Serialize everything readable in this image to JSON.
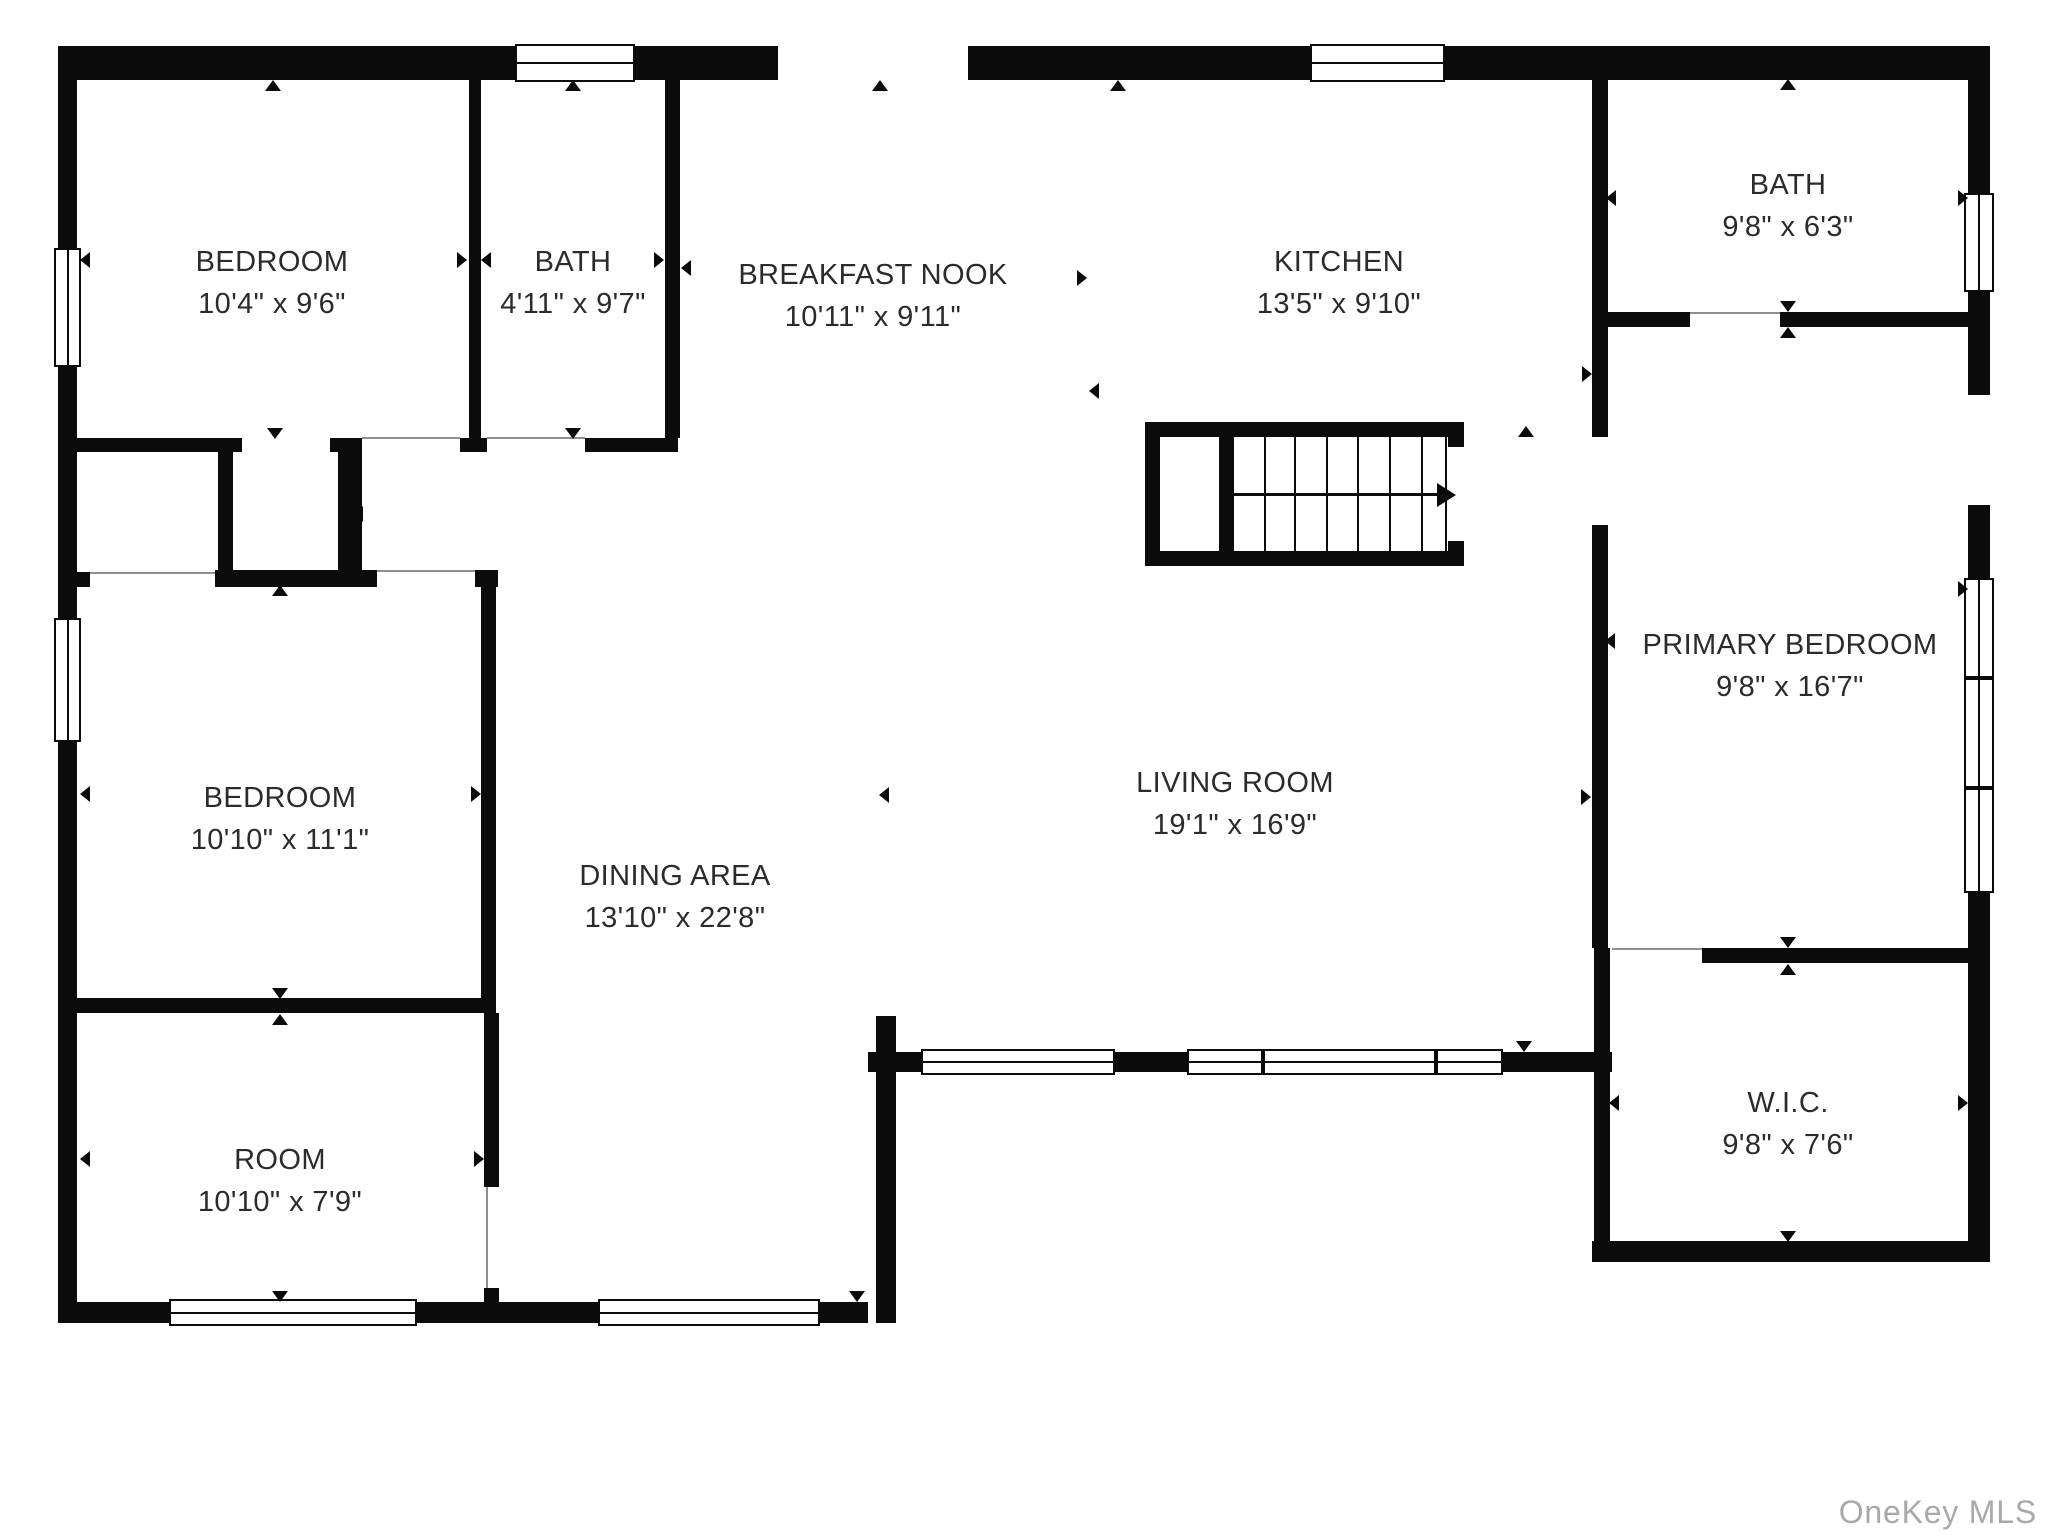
{
  "page": {
    "background": "#ffffff",
    "wall_color": "#0b0b0b",
    "label_color": "#2b2b2b",
    "watermark_color": "#a9a9a9"
  },
  "watermark": "OneKey MLS",
  "rooms": [
    {
      "id": "bedroom-1",
      "name": "BEDROOM",
      "dims": "10'4\" x 9'6\""
    },
    {
      "id": "bath-1",
      "name": "BATH",
      "dims": "4'11\" x 9'7\""
    },
    {
      "id": "breakfast-nook",
      "name": "BREAKFAST NOOK",
      "dims": "10'11\" x 9'11\""
    },
    {
      "id": "kitchen",
      "name": "KITCHEN",
      "dims": "13'5\" x 9'10\""
    },
    {
      "id": "bath-2",
      "name": "BATH",
      "dims": "9'8\" x 6'3\""
    },
    {
      "id": "primary-bedroom",
      "name": "PRIMARY BEDROOM",
      "dims": "9'8\" x 16'7\""
    },
    {
      "id": "wic",
      "name": "W.I.C.",
      "dims": "9'8\" x 7'6\""
    },
    {
      "id": "bedroom-2",
      "name": "BEDROOM",
      "dims": "10'10\" x 11'1\""
    },
    {
      "id": "dining-area",
      "name": "DINING AREA",
      "dims": "13'10\" x 22'8\""
    },
    {
      "id": "living-room",
      "name": "LIVING ROOM",
      "dims": "19'1\" x 16'9\""
    },
    {
      "id": "room",
      "name": "ROOM",
      "dims": "10'10\" x 7'9\""
    }
  ]
}
